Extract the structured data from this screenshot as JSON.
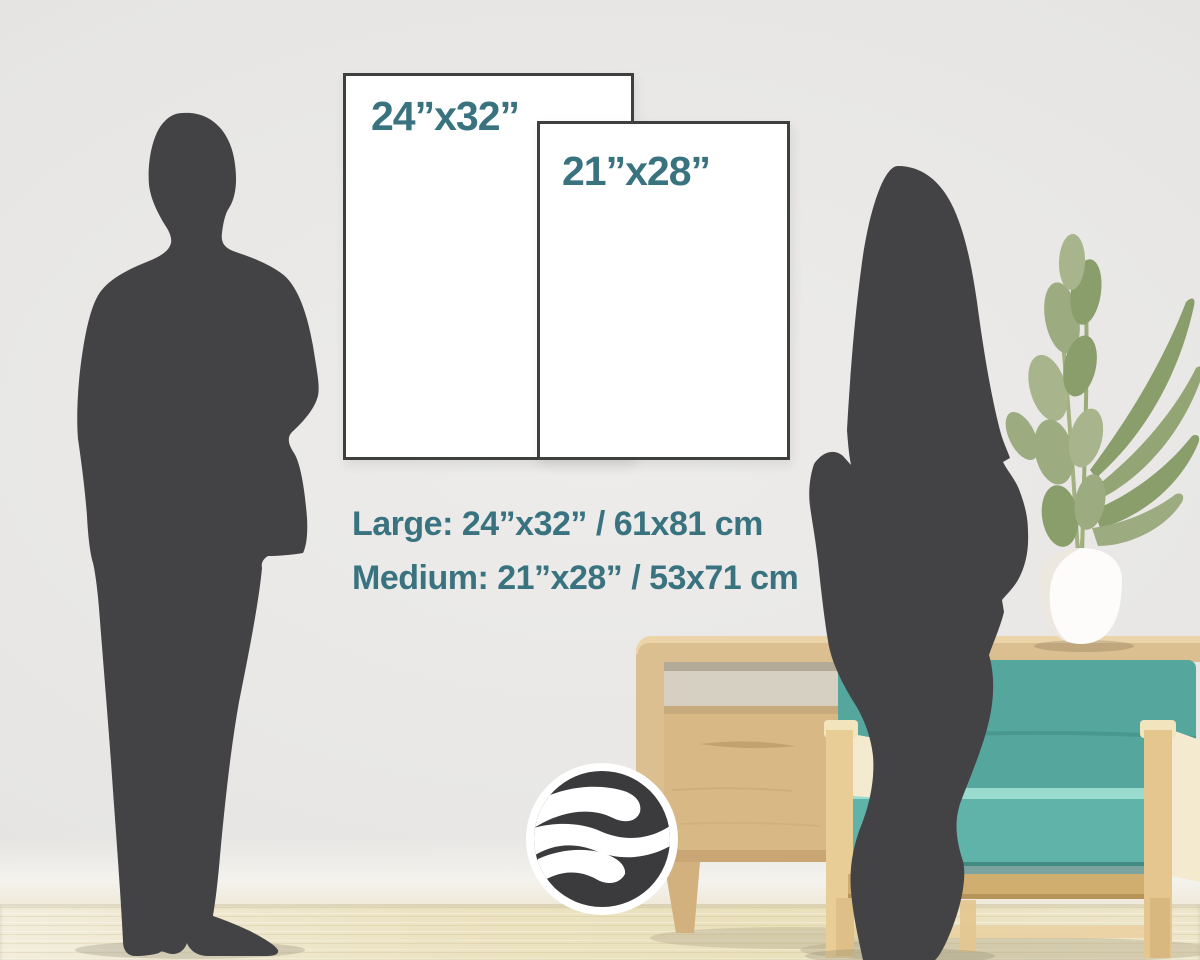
{
  "title": "Poster size comparison guide",
  "posters": {
    "large": {
      "label": "24”x32”"
    },
    "medium": {
      "label": "21”x28”"
    }
  },
  "captions": {
    "large": "Large: 24”x32” / 61x81 cm",
    "medium": "Medium: 21”x28” / 53x71 cm"
  },
  "logo": {
    "name": "wave-circle-logo"
  },
  "scene": {
    "elements": [
      "man-silhouette",
      "woman-silhouette",
      "poster-large",
      "poster-medium",
      "sideboard",
      "sofa-chair",
      "potted-plant",
      "brand-logo",
      "wood-floor"
    ]
  },
  "colors": {
    "accent_text": "#3a7380",
    "poster_border": "#3e3f3f",
    "silhouette": "#434345",
    "sofa_teal": "#55a79e",
    "seat_teal": "#5fb3a9",
    "wood": "#dcbf90",
    "wall": "#e6e5e3",
    "floor": "#ede5c8",
    "logo_dark": "#3b3b3d"
  }
}
